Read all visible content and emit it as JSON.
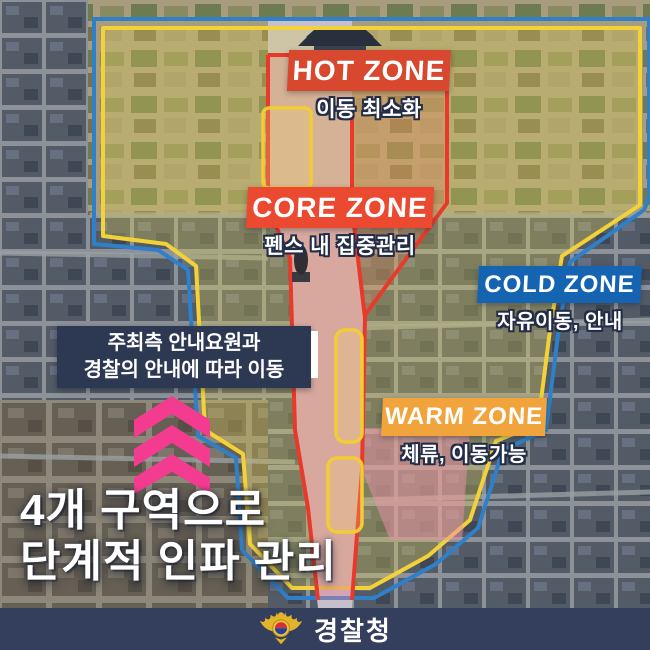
{
  "zones": {
    "hot": {
      "label": "HOT ZONE",
      "desc": "이동 최소화"
    },
    "core": {
      "label": "CORE ZONE",
      "desc": "펜스 내 집중관리"
    },
    "cold": {
      "label": "COLD ZONE",
      "desc": "자유이동, 안내"
    },
    "warm": {
      "label": "WARM ZONE",
      "desc": "체류, 이동가능"
    }
  },
  "guidance_box": {
    "line1": "주최측 안내요원과",
    "line2": "경찰의 안내에 따라 이동"
  },
  "headline": {
    "line1": "4개 구역으로",
    "line2": "단계적 인파 관리"
  },
  "footer": {
    "agency": "경찰청"
  },
  "icons": {
    "arrows": "chevron-up-icon",
    "emblem": "korean-police-emblem-icon"
  },
  "colors": {
    "hot_box": "#d7482f",
    "core_box": "#eb4a31",
    "cold_box": "#1564b2",
    "warm_box": "#f1a43c",
    "guide_navy": "#2d3852",
    "footer_bar": "#343f5d",
    "chevron_pink": "#f33b90",
    "zone_line_yellow": "#f2d238",
    "zone_line_blue": "#2f80c8",
    "zone_line_red": "#e8392b",
    "text_white": "#ffffff",
    "emblem_gold": "#e3b32a",
    "taegeuk_red": "#cf3339",
    "taegeuk_blue": "#23429b"
  }
}
